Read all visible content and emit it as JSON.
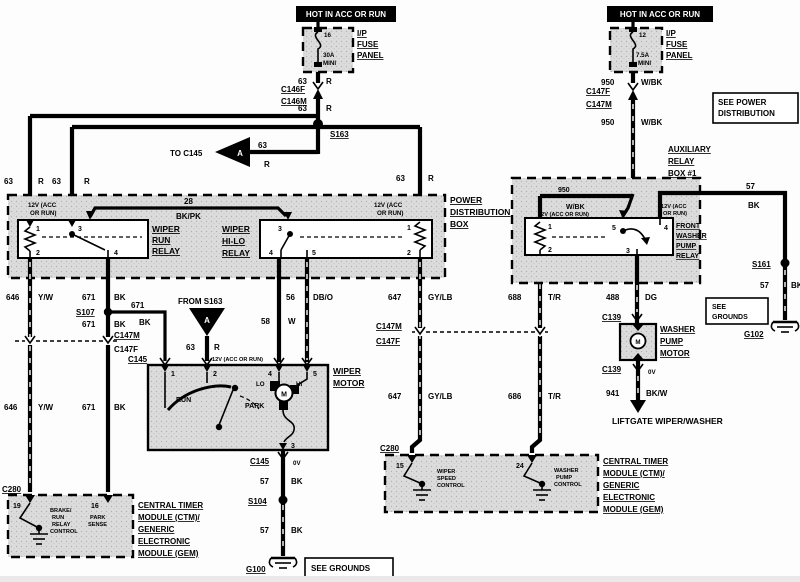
{
  "colors": {
    "ink": "#000000",
    "paper": "#ffffff",
    "stipple": "#d8d8d8"
  },
  "banners": {
    "left": "HOT IN ACC OR RUN",
    "right": "HOT IN ACC OR RUN"
  },
  "fuse_left": {
    "pin": "16",
    "rating": "30A",
    "size": "MINI",
    "panel_l1": "I/P",
    "panel_l2": "FUSE",
    "panel_l3": "PANEL"
  },
  "fuse_right": {
    "pin": "12",
    "rating": "7.5A",
    "size": "MINI",
    "panel_l1": "I/P",
    "panel_l2": "FUSE",
    "panel_l3": "PANEL"
  },
  "wires": {
    "w63": {
      "num": "63",
      "color": "R"
    },
    "w28": {
      "num": "28",
      "color": "BK/PK"
    },
    "w646": {
      "num": "646",
      "color": "Y/W"
    },
    "w671": {
      "num": "671",
      "color": "BK"
    },
    "w56": {
      "num": "56",
      "color": "DB/O"
    },
    "w58": {
      "num": "58",
      "color": "W"
    },
    "w647": {
      "num": "647",
      "color": "GY/LB"
    },
    "w688": {
      "num": "688",
      "color": "T/R"
    },
    "w686": {
      "num": "686",
      "color": "T/R"
    },
    "w950": {
      "num": "950",
      "color": "W/BK"
    },
    "w57": {
      "num": "57",
      "color": "BK"
    },
    "w488": {
      "num": "488",
      "color": "DG"
    },
    "w941": {
      "num": "941",
      "color": "BK/W"
    }
  },
  "connectors": {
    "c146f": "C146F",
    "c146m": "C146M",
    "c147f": "C147F",
    "c147m": "C147M",
    "c145": "C145",
    "c139": "C139",
    "c280": "C280"
  },
  "splices": {
    "s163": "S163",
    "s107": "S107",
    "s104": "S104",
    "s161": "S161"
  },
  "grounds": {
    "g100": "G100",
    "g102": "G102"
  },
  "notes": {
    "to_c145": "TO C145",
    "from_s163": "FROM S163",
    "arrow_a": "A",
    "see_power_l1": "SEE POWER",
    "see_power_l2": "DISTRIBUTION",
    "see_grounds": "SEE GROUNDS",
    "see_grounds_l1": "SEE",
    "see_grounds_l2": "GROUNDS",
    "liftgate": "LIFTGATE WIPER/WASHER",
    "v12_l1": "12V (ACC",
    "v12_l2": "OR RUN)",
    "v12_one_line": "12V (ACC OR RUN)",
    "ov": "0V"
  },
  "power_box": {
    "title_l1": "POWER",
    "title_l2": "DISTRIBUTION",
    "title_l3": "BOX",
    "run_relay": {
      "l1": "WIPER",
      "l2": "RUN",
      "l3": "RELAY",
      "p1": "1",
      "p2": "2",
      "p3": "3",
      "p4": "4"
    },
    "hilo_relay": {
      "l1": "WIPER",
      "l2": "HI-LO",
      "l3": "RELAY",
      "p1": "1",
      "p2": "2",
      "p3": "3",
      "p4": "4",
      "p5": "5"
    }
  },
  "aux_box": {
    "title_l1": "AUXILIARY",
    "title_l2": "RELAY",
    "title_l3": "BOX #1",
    "relay": {
      "l1": "FRONT",
      "l2": "WASHER",
      "l3": "PUMP",
      "l4": "RELAY",
      "p1": "1",
      "p2": "2",
      "p3": "3",
      "p4": "4",
      "p5": "5"
    }
  },
  "wiper_motor": {
    "l1": "WIPER",
    "l2": "MOTOR",
    "m": "M",
    "lo": "LO",
    "hi": "HI",
    "run": "RUN",
    "park": "PARK",
    "p1": "1",
    "p2": "2",
    "p3": "3",
    "p4": "4",
    "p5": "5"
  },
  "washer_motor": {
    "l1": "WASHER",
    "l2": "PUMP",
    "l3": "MOTOR",
    "m": "M"
  },
  "ctm": {
    "title_l1": "CENTRAL TIMER",
    "title_l2": "MODULE (CTM)/",
    "title_l3": "GENERIC",
    "title_l4": "ELECTRONIC",
    "title_l5": "MODULE (GEM)",
    "left": {
      "p19": "19",
      "p16": "16",
      "brake_l1": "BRAKE/",
      "brake_l2": "RUN",
      "brake_l3": "RELAY",
      "brake_l4": "CONTROL",
      "park_l1": "PARK",
      "park_l2": "SENSE"
    },
    "right": {
      "p15": "15",
      "p24": "24",
      "wiper_l1": "WIPER",
      "wiper_l2": "SPEED",
      "wiper_l3": "CONTROL",
      "washer_l1": "WASHER",
      "washer_l2": "PUMP",
      "washer_l3": "CONTROL"
    }
  }
}
